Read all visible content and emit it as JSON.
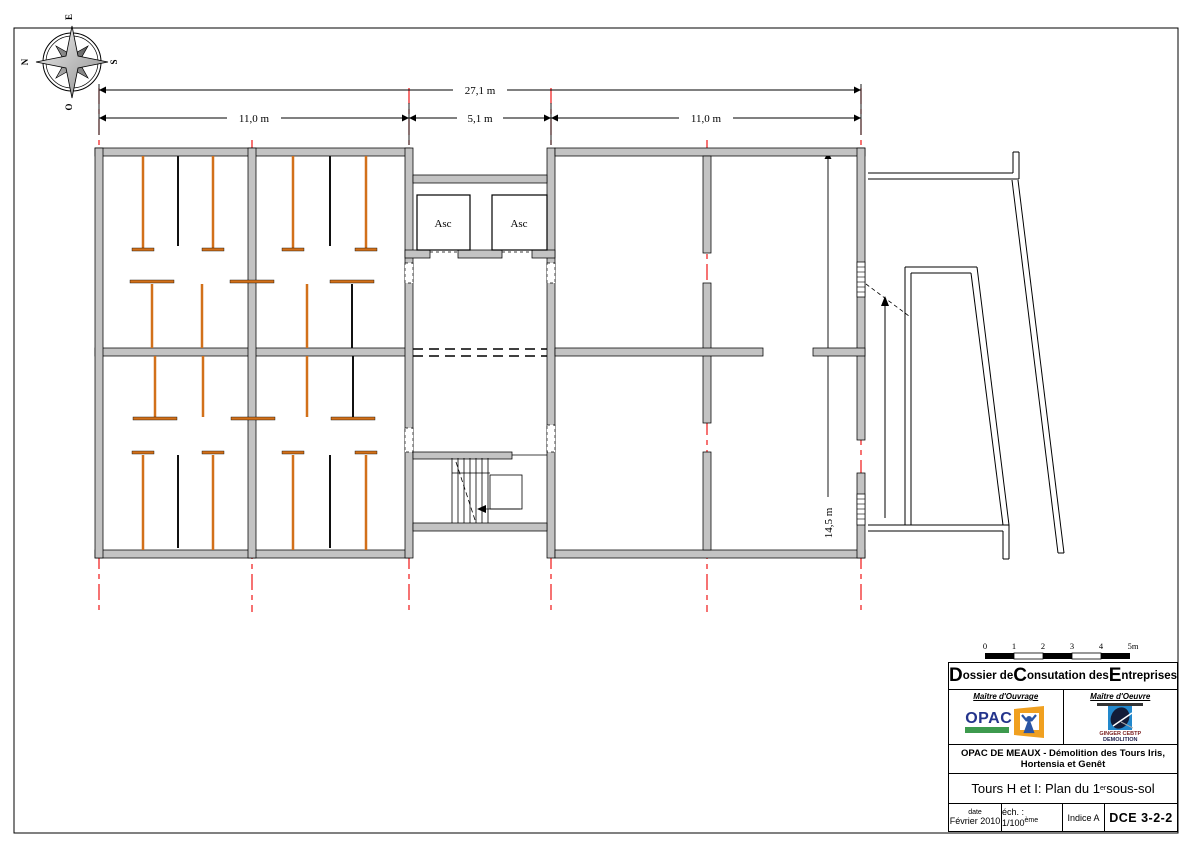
{
  "colors": {
    "wall_fill": "#c3c3c3",
    "grid_red": "#ee0000",
    "partition_orange": "#d2701a",
    "partition_black": "#111111",
    "opac_blue": "#24348c",
    "opac_green": "#3d9a4e",
    "opac_orange": "#f0a020",
    "ginger_blue": "#2288cc",
    "ginger_navy": "#131c38"
  },
  "compass": {
    "n": "N",
    "e": "E",
    "s": "S",
    "o": "O"
  },
  "dimensions": {
    "total": "27,1 m",
    "left_bay": "11,0 m",
    "center_bay": "5,1 m",
    "right_bay": "11,0 m",
    "depth": "14,5 m"
  },
  "labels": {
    "elevator1": "Asc",
    "elevator2": "Asc"
  },
  "scalebar": {
    "t0": "0",
    "t1": "1",
    "t2": "2",
    "t3": "3",
    "t4": "4",
    "t5": "5m"
  },
  "titleblock": {
    "header_parts": {
      "p0": "D",
      "p1": "ossier de ",
      "p2": "C",
      "p3": "onsutation des ",
      "p4": "E",
      "p5": "ntreprises"
    },
    "owner_label": "Maître d'Ouvrage",
    "architect_label": "Maître d'Oeuvre",
    "opac_text": "OPAC",
    "ginger_line1": "GINGER CEBTP",
    "ginger_line2": "DEMOLITION",
    "project_line1": "OPAC DE MEAUX - Démolition des Tours Iris,",
    "project_line2": "Hortensia et Genêt",
    "sheet_prefix": "Tours H et I: Plan du 1",
    "sheet_sup": "er",
    "sheet_suffix": " sous-sol",
    "date_label": "date",
    "date_value": "Février 2010",
    "scale_prefix": "éch. : 1/100",
    "scale_sup": "ème",
    "index": "Indice A",
    "code": "DCE 3-2-2"
  }
}
